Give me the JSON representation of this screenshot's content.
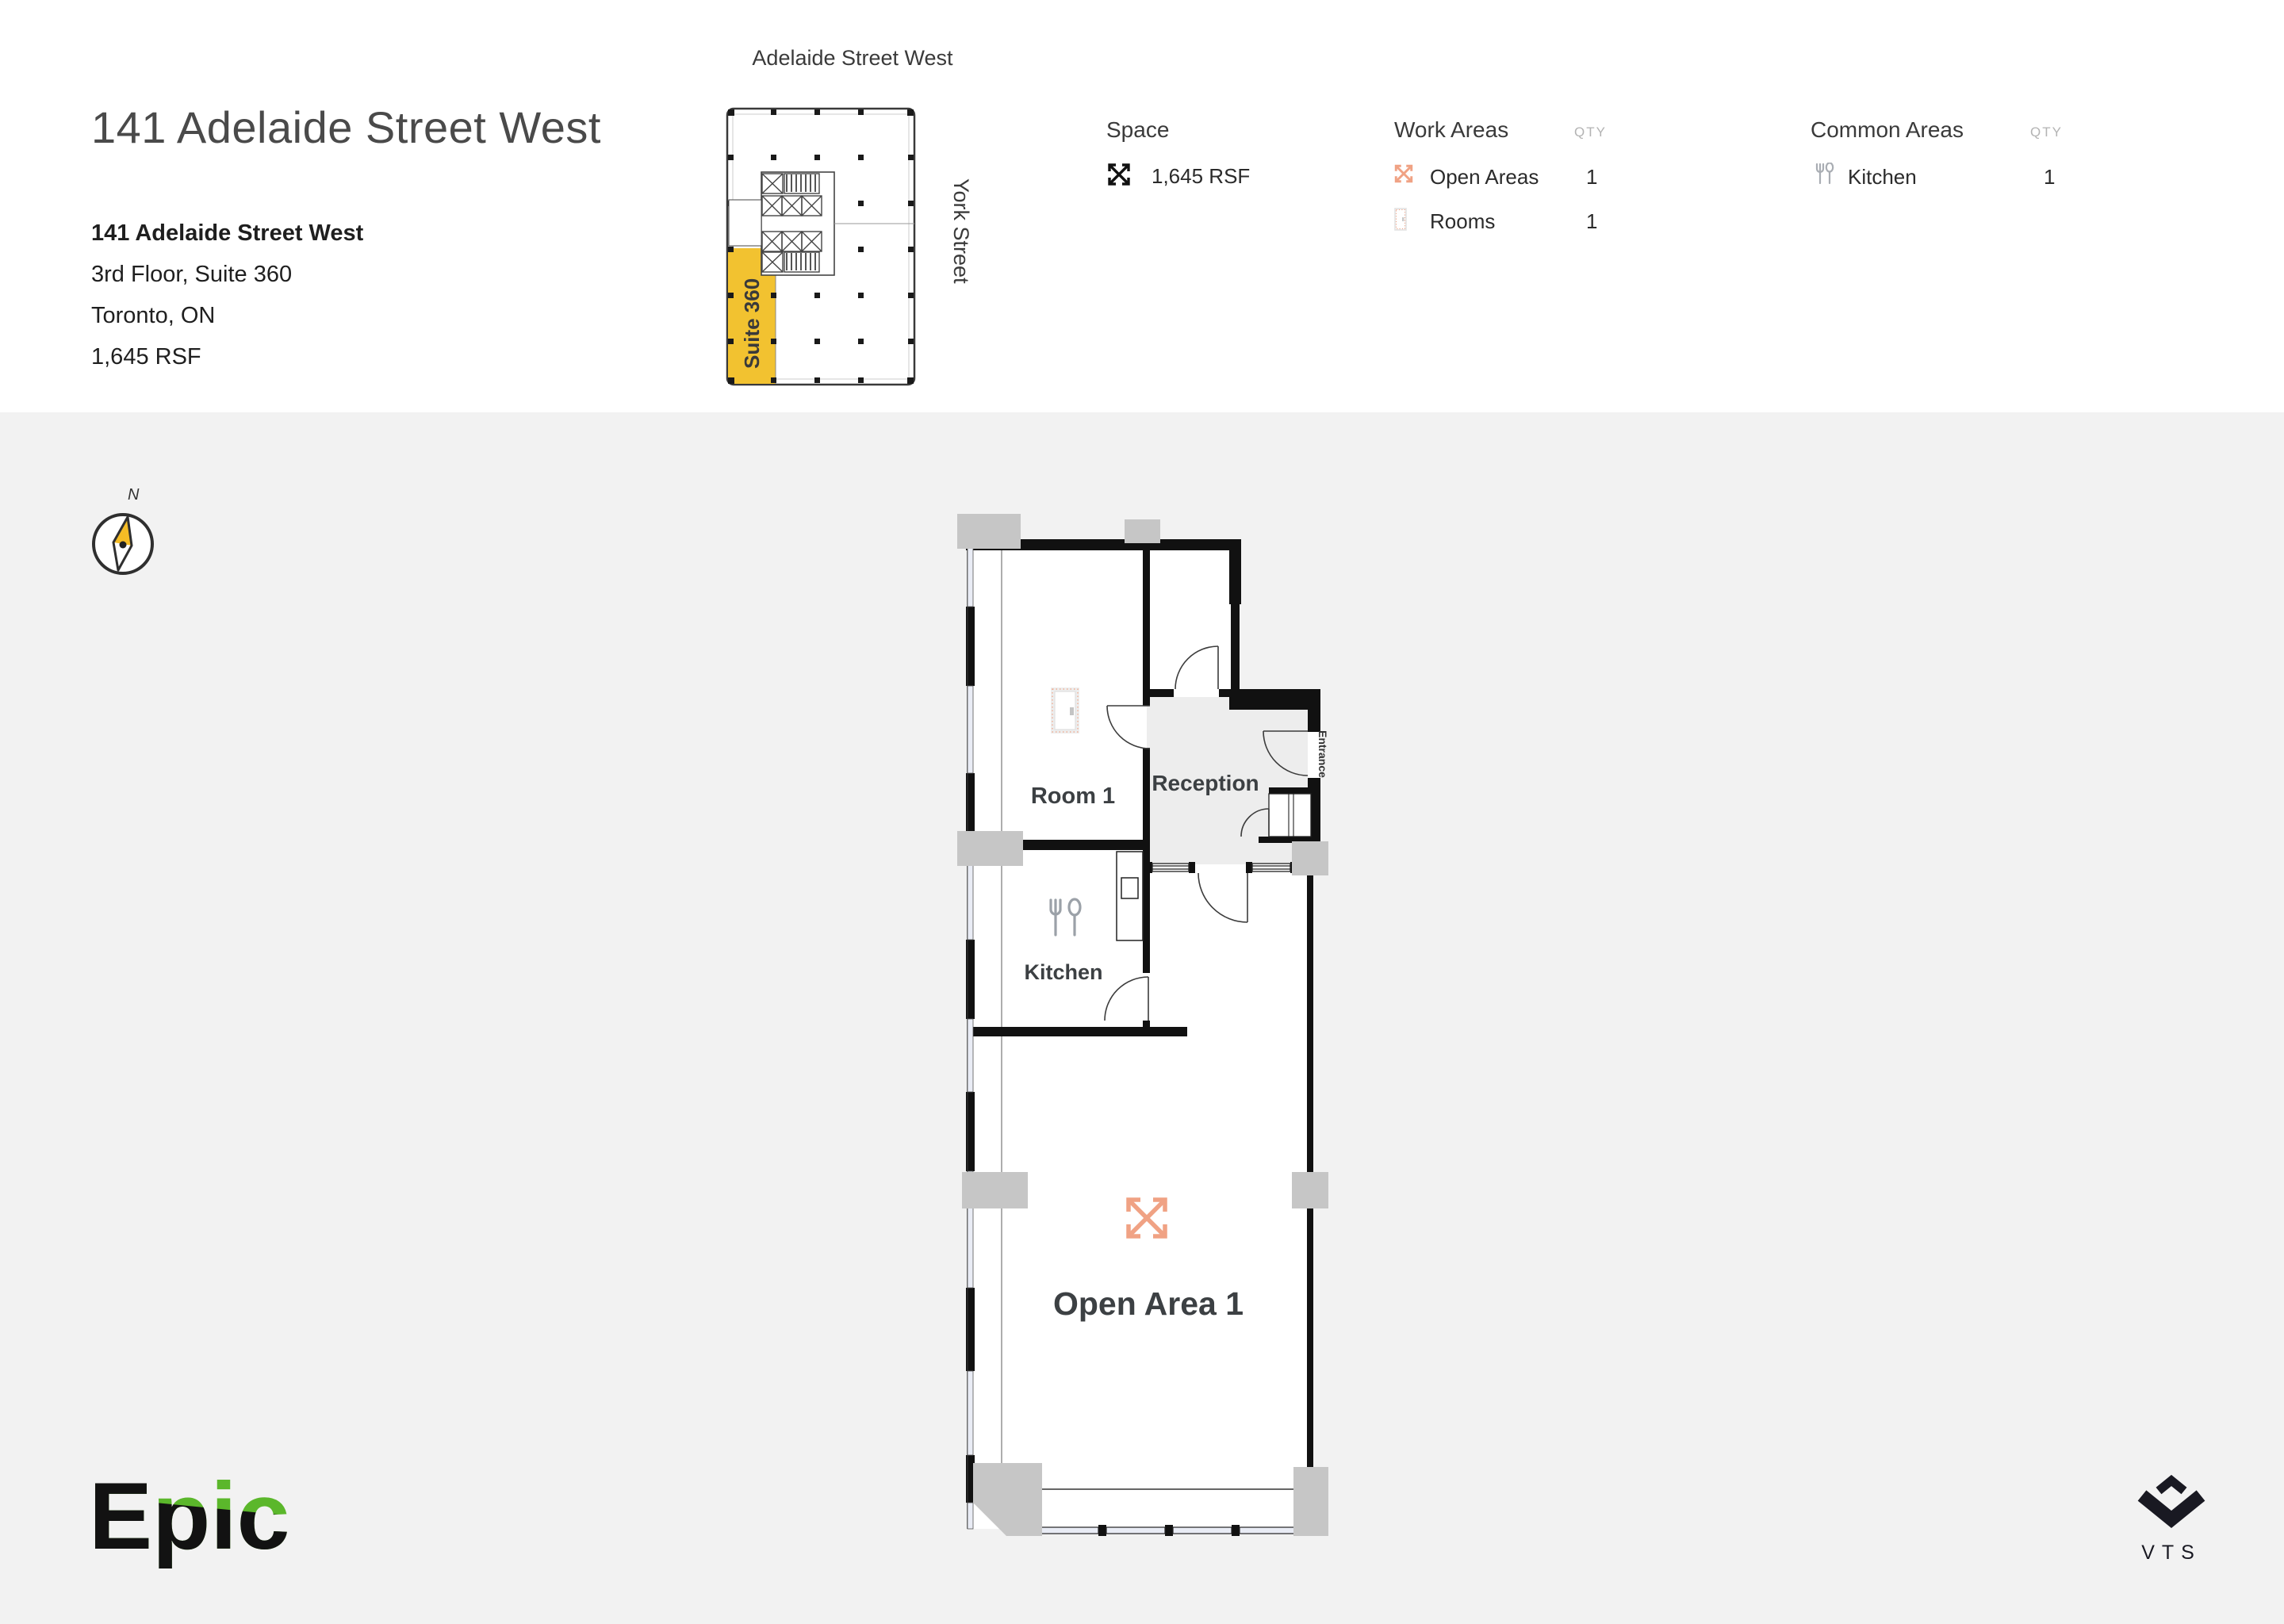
{
  "header": {
    "title": "141 Adelaide Street West",
    "building": {
      "name": "141 Adelaide Street West",
      "floor": "3rd Floor, Suite 360",
      "city": "Toronto, ON",
      "size": "1,645 RSF"
    },
    "minimap": {
      "street_top": "Adelaide Street West",
      "street_right": "York Street",
      "suite": "Suite 360"
    },
    "legend": {
      "space": {
        "heading": "Space",
        "value": "1,645 RSF"
      },
      "work_areas": {
        "heading": "Work Areas",
        "qty": "QTY",
        "rows": [
          {
            "icon": "open-area-icon",
            "label": "Open Areas",
            "qty": "1"
          },
          {
            "icon": "room-door-icon",
            "label": "Rooms",
            "qty": "1"
          }
        ]
      },
      "common_areas": {
        "heading": "Common Areas",
        "qty": "QTY",
        "rows": [
          {
            "icon": "kitchen-icon",
            "label": "Kitchen",
            "qty": "1"
          }
        ]
      }
    }
  },
  "plan": {
    "compass": "N",
    "labels": {
      "room1": "Room 1",
      "reception": "Reception",
      "kitchen": "Kitchen",
      "open_area": "Open Area 1",
      "entrance": "Entrance"
    }
  },
  "branding": {
    "epic": "Epic",
    "vts": "VTS"
  },
  "colors": {
    "suite_yellow": "#F2C230",
    "accent_orange": "#F0A284",
    "reception_fill": "#EDEDED",
    "wall": "#111111",
    "body_bg": "#F2F2F2",
    "epic_green": "#5BB72B",
    "column_grey": "#C6C6C6"
  }
}
